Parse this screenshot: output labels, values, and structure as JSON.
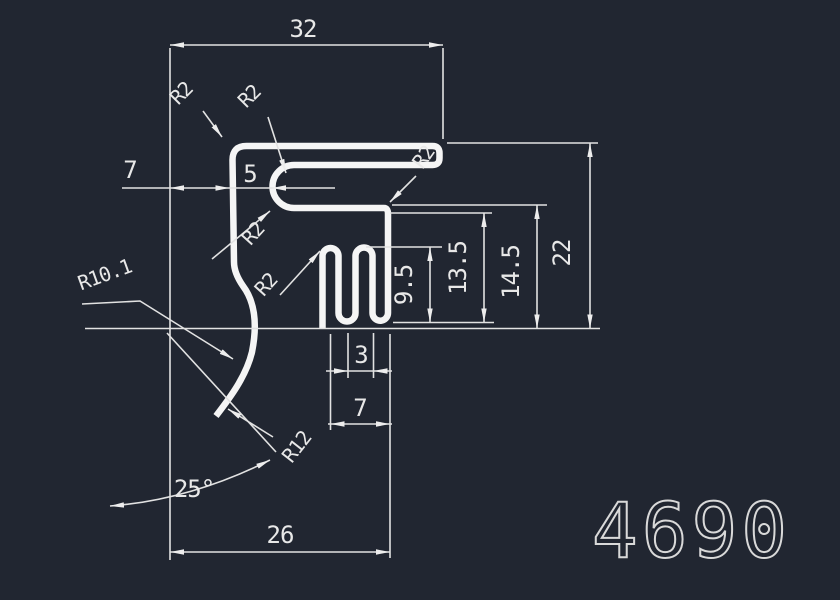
{
  "drawing": {
    "part_number": "4690",
    "colors": {
      "background": "#212631",
      "line": "#ededed"
    },
    "dimensions": {
      "top_width": "32",
      "left_offset": "7",
      "lip_inset": "5",
      "slot_width": "3",
      "comb_width": "7",
      "bottom_width": "26",
      "tooth_height": "9.5",
      "inner_height": "13.5",
      "lip_height": "14.5",
      "total_height": "22",
      "tip_angle": "25°"
    },
    "radii": {
      "top_corner": "R2",
      "step": "R2",
      "cap": "R2",
      "tower": "R2",
      "riser": "R2",
      "hook": "R10.1",
      "tip": "R12"
    }
  }
}
